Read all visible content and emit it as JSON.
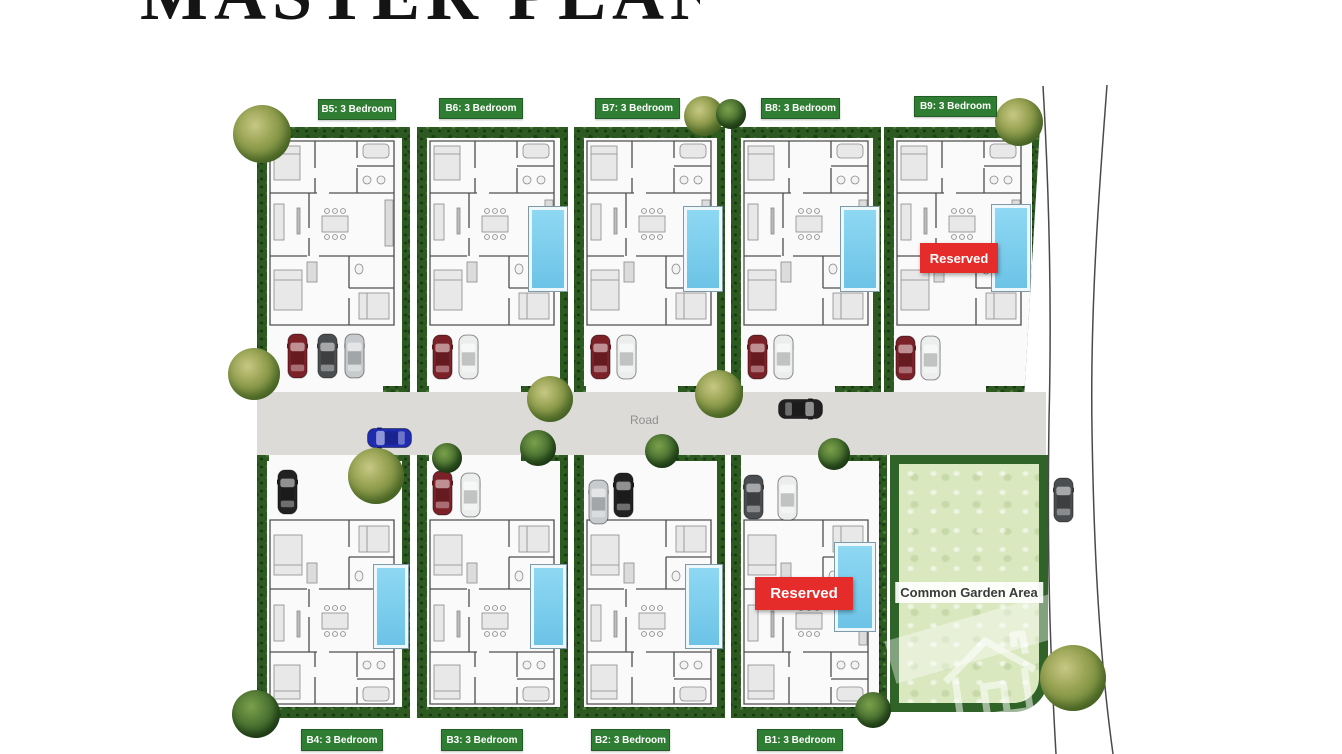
{
  "title": "MASTER PLAN",
  "site": {
    "road_label": "Road",
    "common_garden_label": "Common Garden Area",
    "reserved_label": "Reserved",
    "reserved_units": [
      "B9",
      "B1"
    ],
    "units": [
      {
        "id": "B5",
        "label": "B5: 3 Bedroom",
        "bedrooms": 3,
        "row": "top",
        "reserved": false,
        "pool": false,
        "parked_cars": [
          "red",
          "gray",
          "silver"
        ]
      },
      {
        "id": "B6",
        "label": "B6: 3 Bedroom",
        "bedrooms": 3,
        "row": "top",
        "reserved": false,
        "pool": true,
        "parked_cars": [
          "red",
          "white"
        ]
      },
      {
        "id": "B7",
        "label": "B7: 3 Bedroom",
        "bedrooms": 3,
        "row": "top",
        "reserved": false,
        "pool": true,
        "parked_cars": [
          "red",
          "white"
        ]
      },
      {
        "id": "B8",
        "label": "B8: 3 Bedroom",
        "bedrooms": 3,
        "row": "top",
        "reserved": false,
        "pool": true,
        "parked_cars": [
          "red",
          "white"
        ]
      },
      {
        "id": "B9",
        "label": "B9: 3 Bedroom",
        "bedrooms": 3,
        "row": "top",
        "reserved": true,
        "pool": true,
        "parked_cars": [
          "red",
          "white"
        ]
      },
      {
        "id": "B4",
        "label": "B4: 3 Bedroom",
        "bedrooms": 3,
        "row": "bottom",
        "reserved": false,
        "pool": true,
        "parked_cars": [
          "black"
        ]
      },
      {
        "id": "B3",
        "label": "B3: 3 Bedroom",
        "bedrooms": 3,
        "row": "bottom",
        "reserved": false,
        "pool": true,
        "parked_cars": [
          "red",
          "white"
        ]
      },
      {
        "id": "B2",
        "label": "B2: 3 Bedroom",
        "bedrooms": 3,
        "row": "bottom",
        "reserved": false,
        "pool": true,
        "parked_cars": [
          "silver",
          "black"
        ]
      },
      {
        "id": "B1",
        "label": "B1: 3 Bedroom",
        "bedrooms": 3,
        "row": "bottom",
        "reserved": true,
        "pool": true,
        "parked_cars": [
          "gray",
          "white"
        ]
      }
    ],
    "road_cars": [
      {
        "color": "blue",
        "location": "main-road-west"
      },
      {
        "color": "black",
        "location": "main-road-east"
      },
      {
        "color": "gray",
        "location": "side-road"
      }
    ]
  },
  "icons": {
    "watermark": "house-outline"
  },
  "colors": {
    "label_green": "#2e7d32",
    "reserved_red": "#e62b2b",
    "road_gray": "#dcdbd8",
    "hedge_green": "#2c5a21",
    "garden_green": "#d9e8bf",
    "pool_blue": "#7fd0ee",
    "title_black": "#141414"
  }
}
